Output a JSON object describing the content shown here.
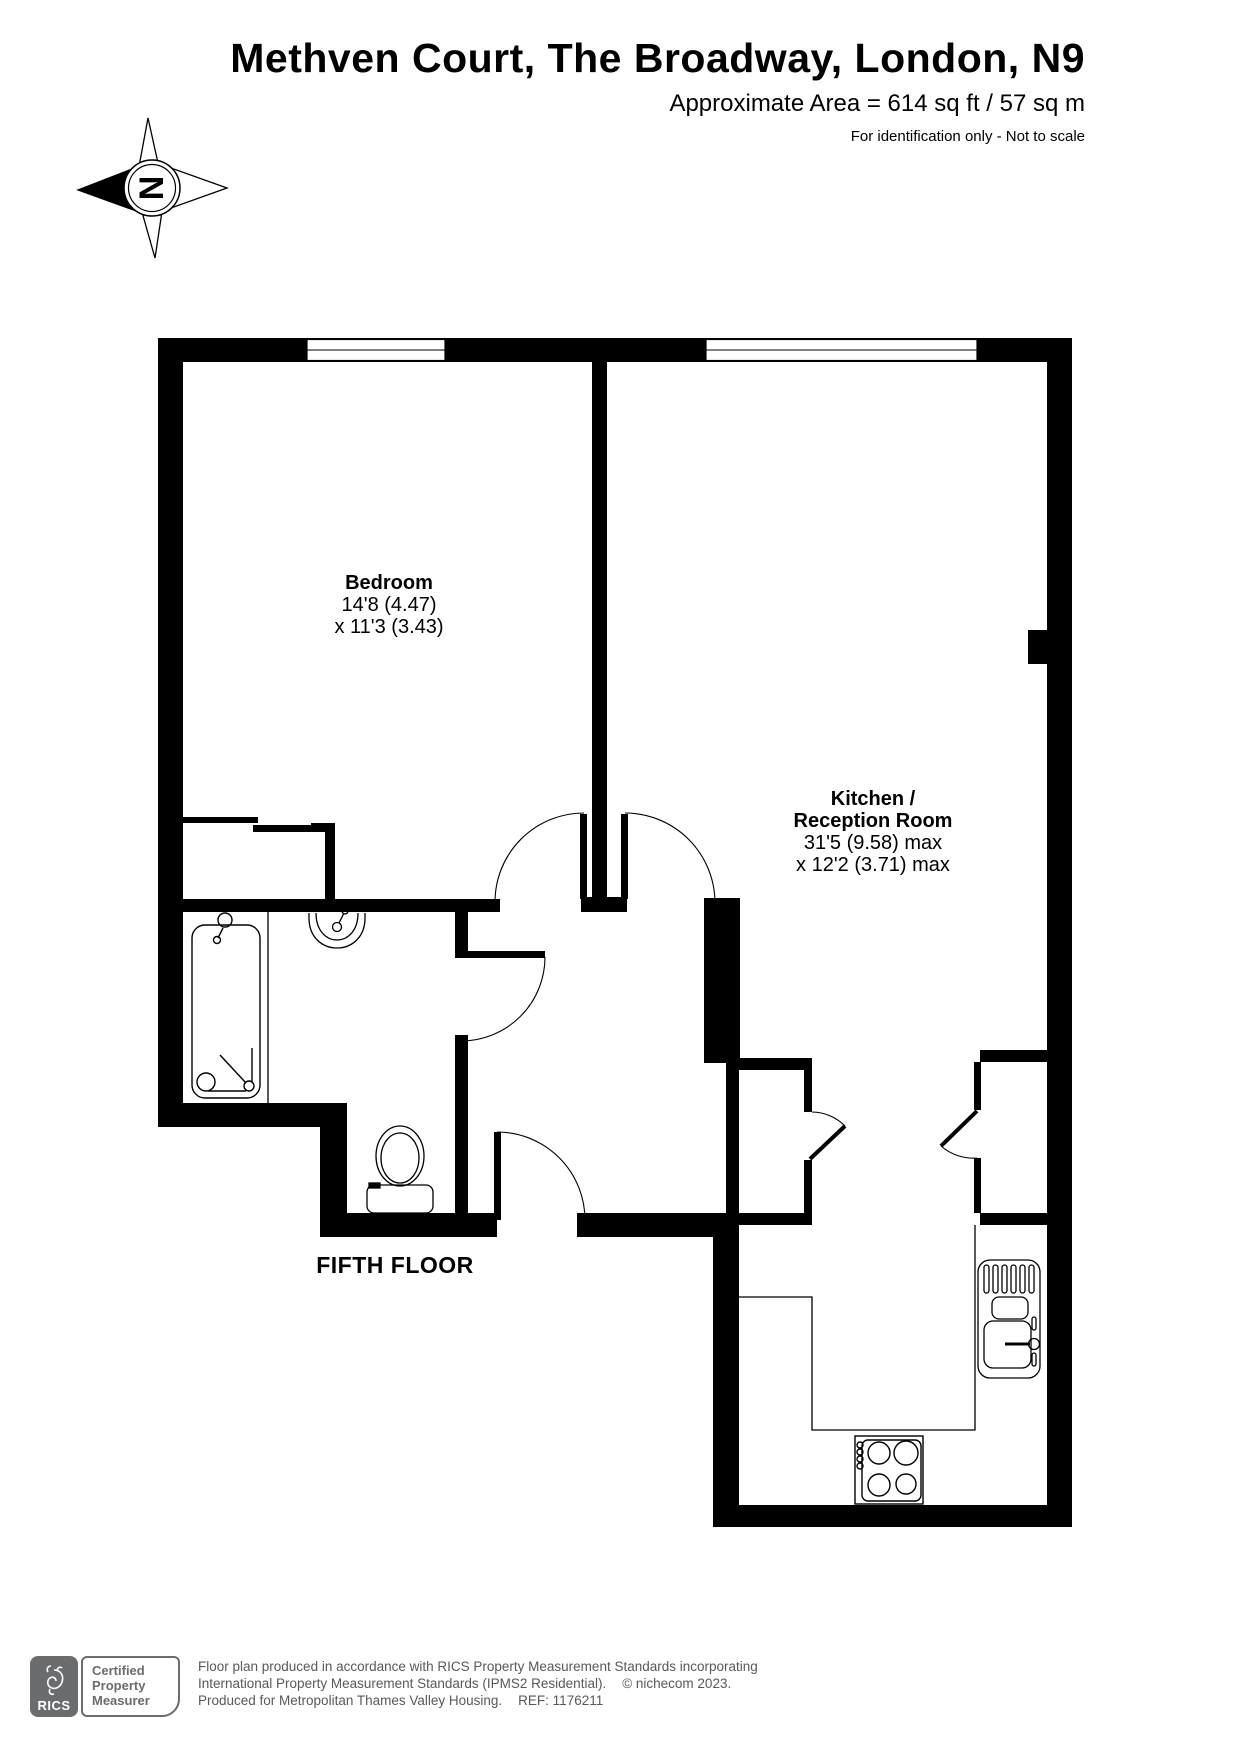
{
  "header": {
    "title": "Methven Court, The Broadway, London, N9",
    "area": "Approximate Area = 614 sq ft / 57 sq m",
    "disclaimer": "For identification only - Not to scale"
  },
  "plan": {
    "compass_letter": "N",
    "floor_label": "FIFTH FLOOR",
    "bedroom": {
      "name": "Bedroom",
      "dim1": "14'8 (4.47)",
      "dim2": "x 11'3 (3.43)"
    },
    "kitchen": {
      "name1": "Kitchen /",
      "name2": "Reception Room",
      "dim1": "31'5 (9.58) max",
      "dim2": "x 12'2 (3.71) max"
    }
  },
  "footer": {
    "rics": "RICS",
    "badge1": "Certified",
    "badge2": "Property",
    "badge3": "Measurer",
    "line1": "Floor plan produced in accordance with RICS Property Measurement Standards incorporating",
    "line2a": "International Property Measurement Standards (IPMS2 Residential).",
    "line2b": "© nichecom 2023.",
    "line3a": "Produced for Metropolitan Thames Valley Housing.",
    "line3b": "REF:  1176211"
  },
  "colors": {
    "plan_black": "#000000",
    "footer_gray": "#58595b",
    "logo_gray": "#6a6c6e"
  }
}
